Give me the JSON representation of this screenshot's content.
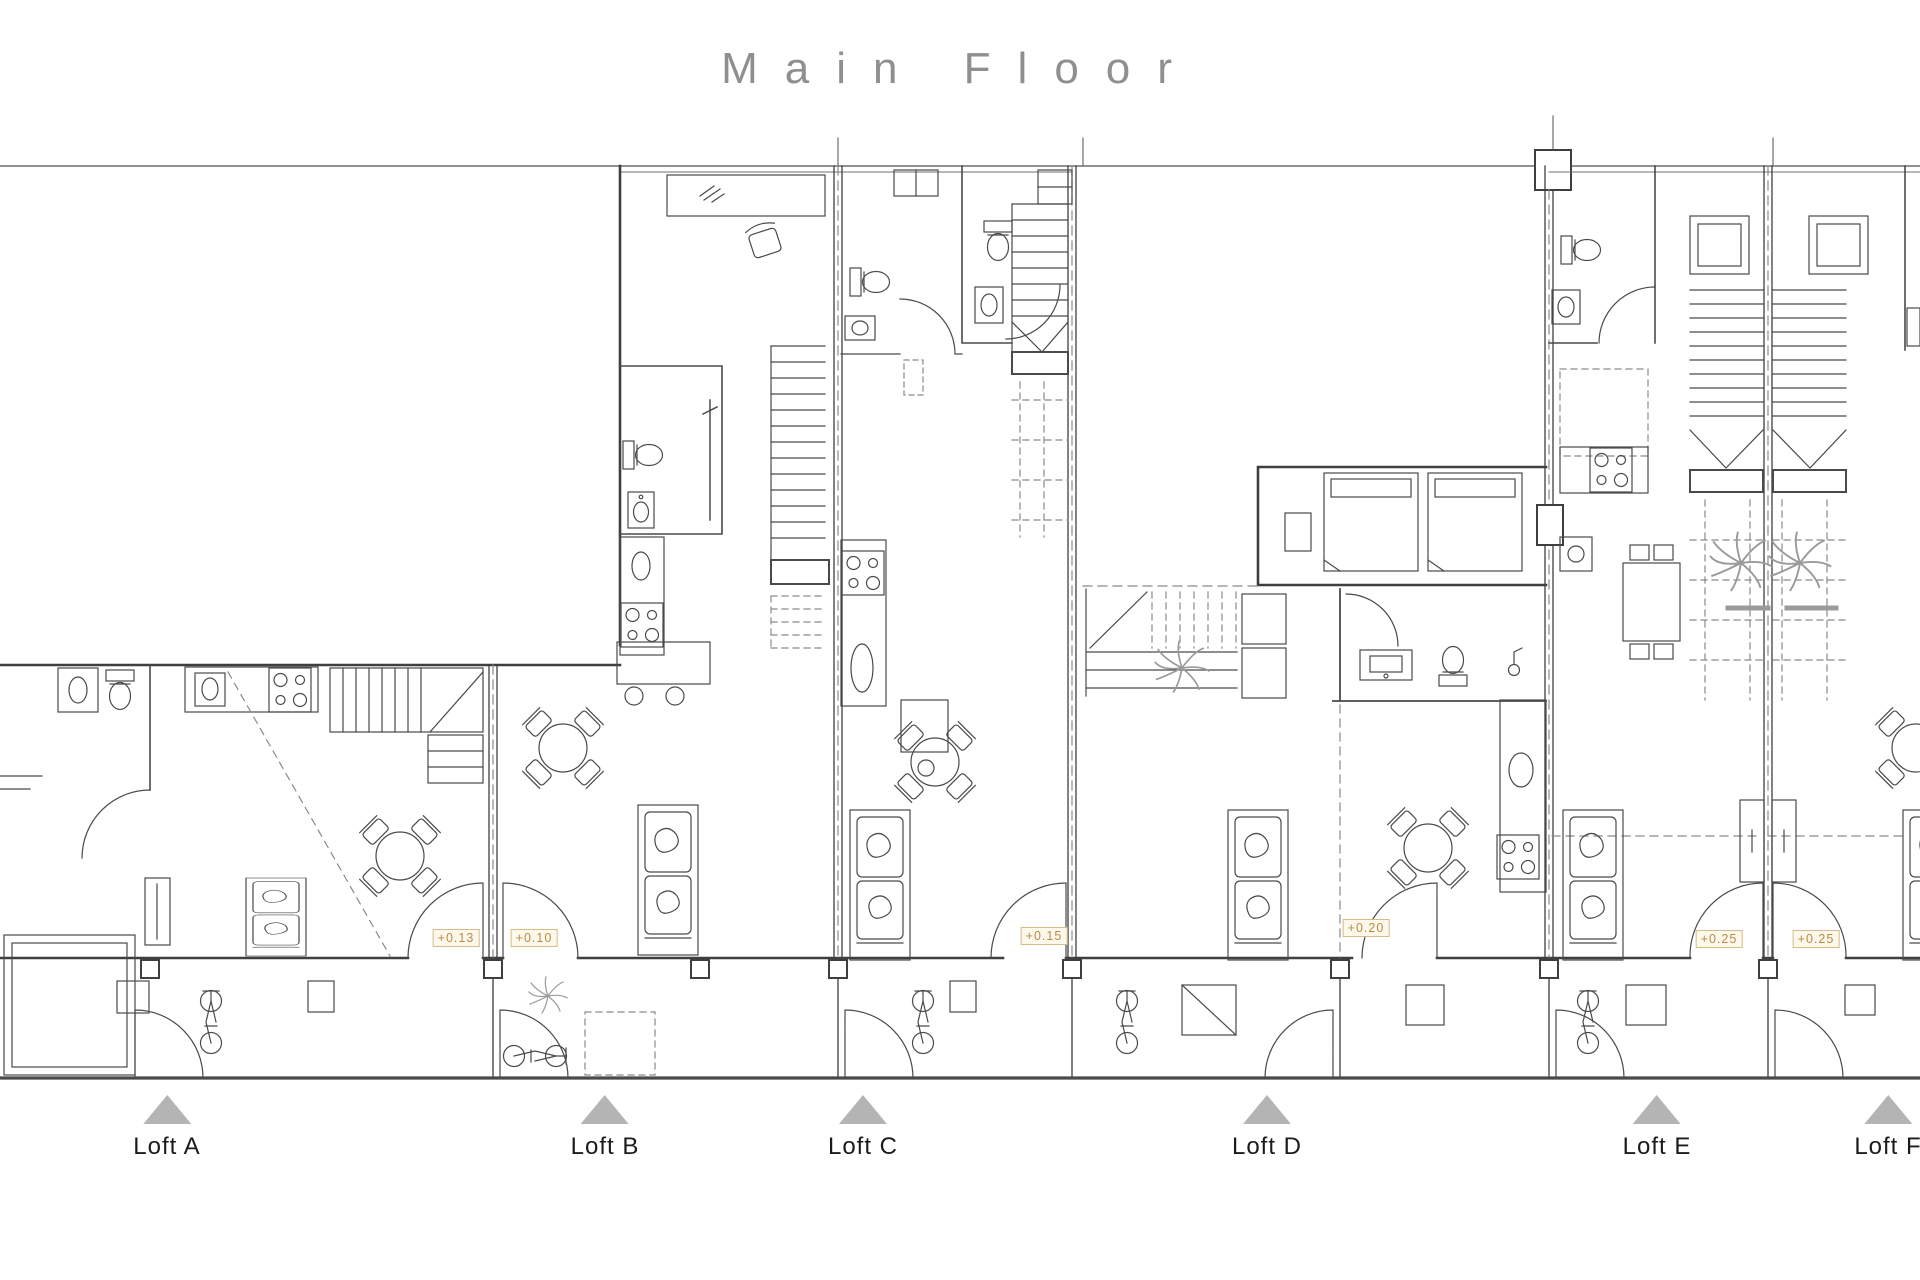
{
  "title": {
    "text": "Main Floor"
  },
  "lofts": [
    {
      "id": "loft-a",
      "label": "Loft A"
    },
    {
      "id": "loft-b",
      "label": "Loft B"
    },
    {
      "id": "loft-c",
      "label": "Loft C"
    },
    {
      "id": "loft-d",
      "label": "Loft D"
    },
    {
      "id": "loft-e",
      "label": "Loft E"
    },
    {
      "id": "loft-f",
      "label": "Loft F"
    }
  ],
  "elevation_markers": [
    {
      "value": "+0.13"
    },
    {
      "value": "+0.10"
    },
    {
      "value": "+0.15"
    },
    {
      "value": "+0.20"
    },
    {
      "value": "+0.25"
    },
    {
      "value": "+0.25"
    }
  ],
  "colors": {
    "line": "#4a4a4a",
    "thin_line": "#5c5c5c",
    "dash_line": "#8a8a8a",
    "title_text": "#8f8f8f",
    "label_text": "#1b1b1b",
    "marker_triangle": "#b4b4b4",
    "elevation_text": "#bc8a45",
    "elevation_border": "#d9bb86",
    "elevation_bg": "#fdf8ec",
    "ground_line": "#4a4a4a"
  }
}
